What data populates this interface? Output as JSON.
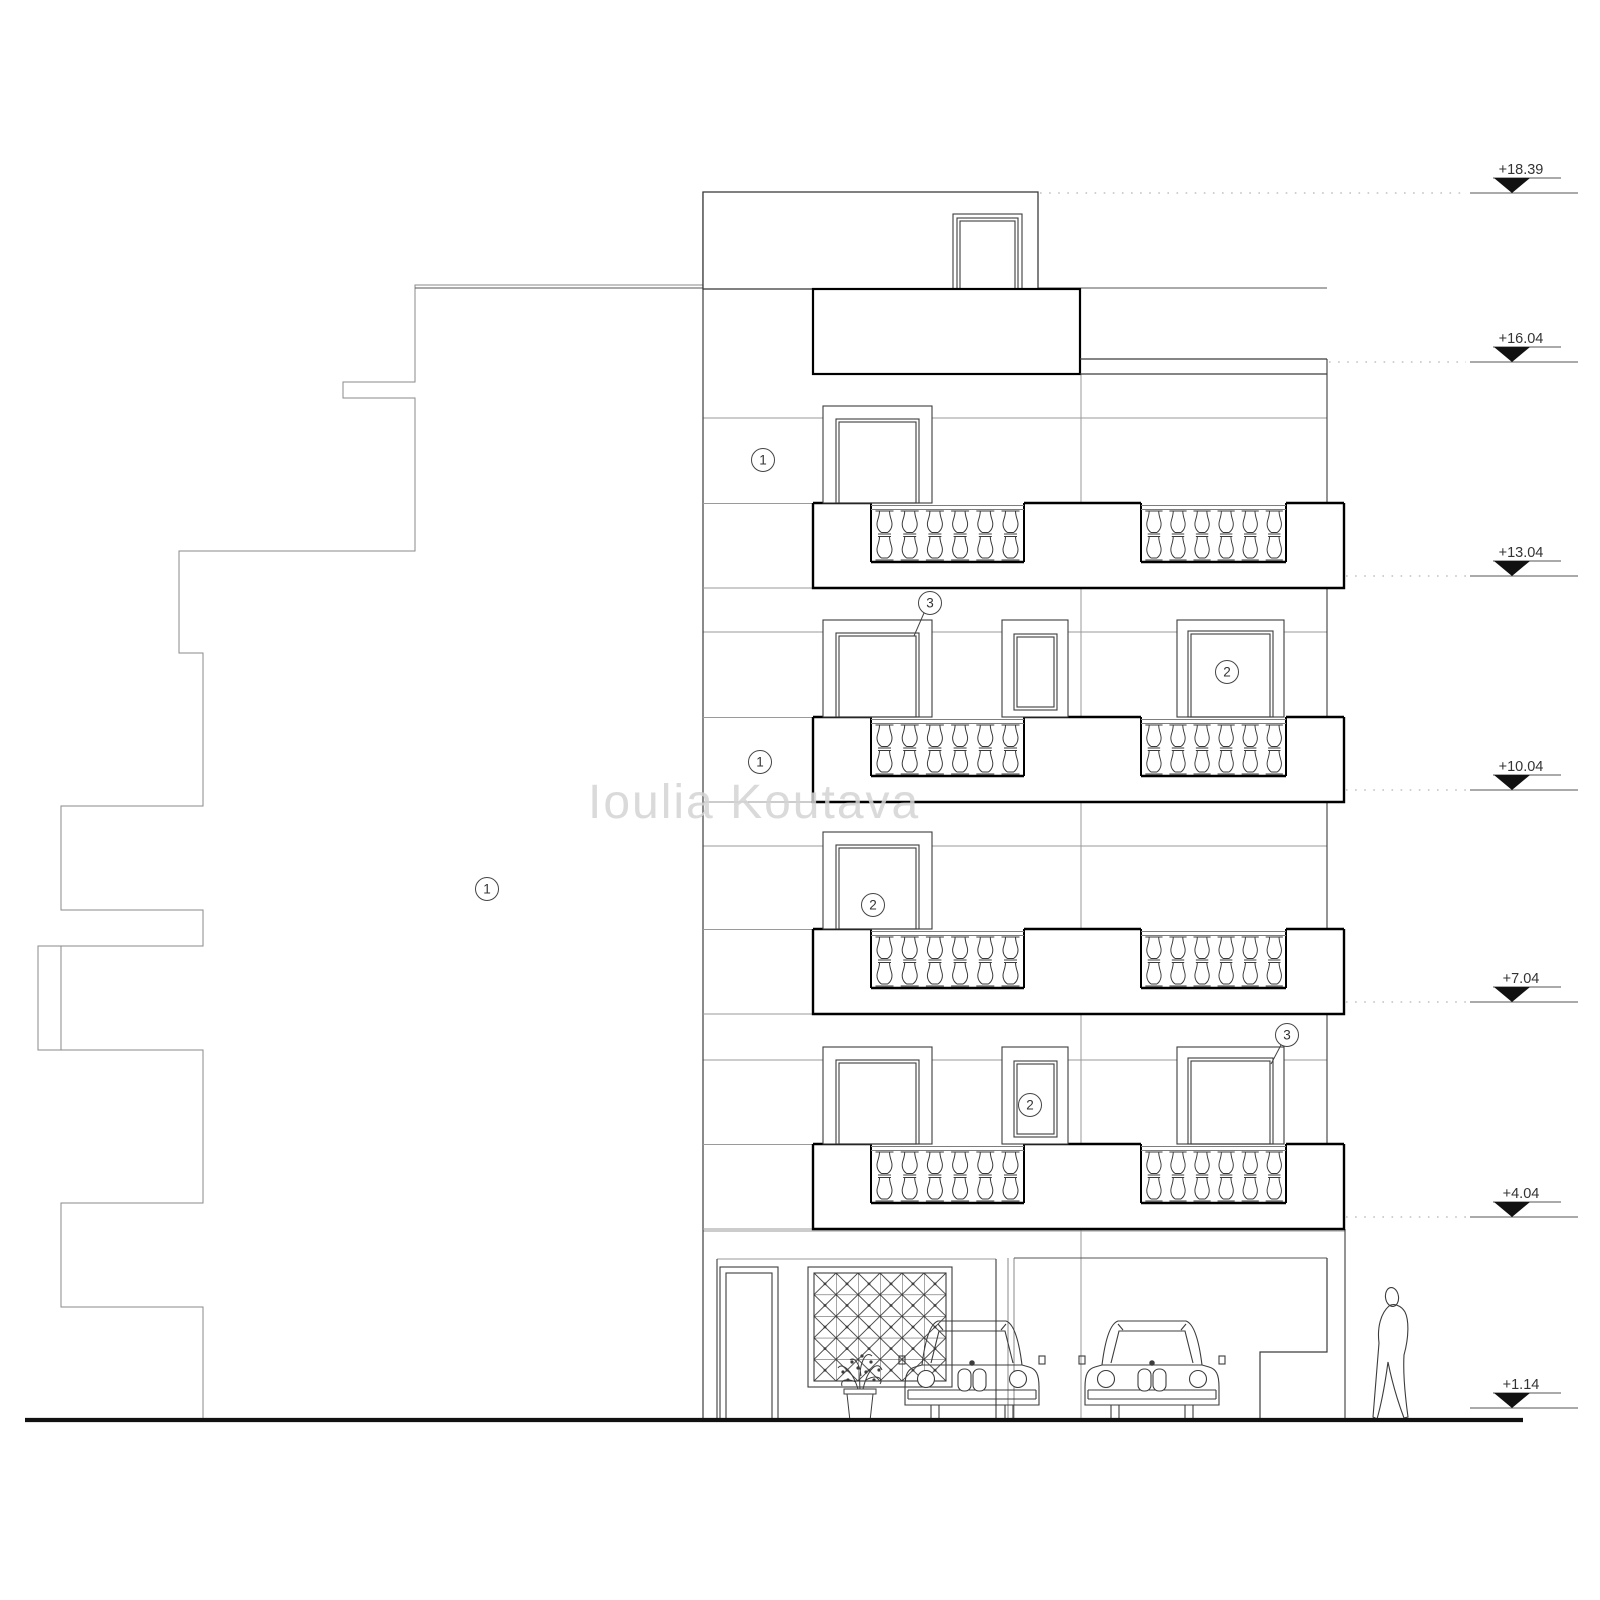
{
  "document": {
    "type": "architectural elevation drawing",
    "watermark": "Ioulia Koutava"
  },
  "levels": [
    {
      "label": "+18.39"
    },
    {
      "label": "+16.04"
    },
    {
      "label": "+13.04"
    },
    {
      "label": "+10.04"
    },
    {
      "label": "+7.04"
    },
    {
      "label": "+4.04"
    },
    {
      "label": "+1.14"
    }
  ],
  "callouts": [
    {
      "label": "1"
    },
    {
      "label": "3"
    },
    {
      "label": "2"
    },
    {
      "label": "1"
    },
    {
      "label": "1"
    },
    {
      "label": "2"
    },
    {
      "label": "2"
    },
    {
      "label": "3"
    }
  ],
  "colors": {
    "line": "#3c3c3c",
    "thick": "#000000",
    "light": "#9a9a9a",
    "dotted": "#b4b4b4",
    "marker": "#111111",
    "watermark": "#d4d4d4"
  }
}
